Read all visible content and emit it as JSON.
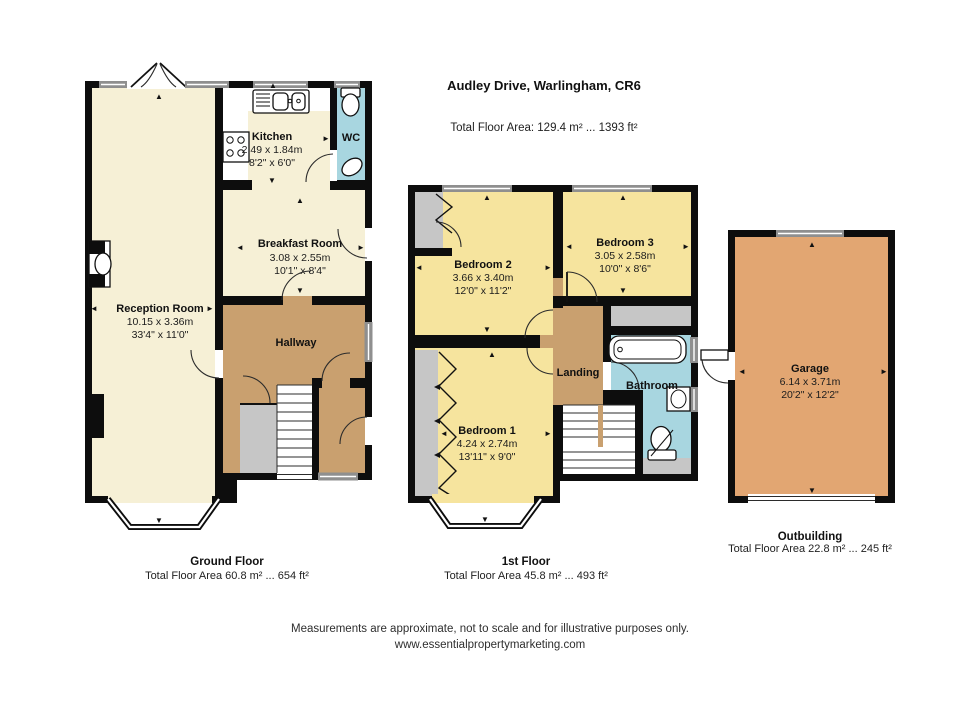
{
  "header": {
    "title": "Audley Drive, Warlingham, CR6",
    "subtitle": "Total Floor Area: 129.4 m² ... 1393 ft²"
  },
  "ground_floor": {
    "caption": "Ground Floor",
    "area": "Total Floor Area 60.8 m² ... 654 ft²",
    "rooms": {
      "reception": {
        "name": "Reception Room",
        "dim_m": "10.15 x 3.36m",
        "dim_ft": "33'4\" x 11'0\""
      },
      "kitchen": {
        "name": "Kitchen",
        "dim_m": "2.49 x 1.84m",
        "dim_ft": "8'2\" x 6'0\""
      },
      "wc": {
        "name": "WC"
      },
      "breakfast": {
        "name": "Breakfast Room",
        "dim_m": "3.08 x 2.55m",
        "dim_ft": "10'1\" x 8'4\""
      },
      "hallway": {
        "name": "Hallway"
      }
    }
  },
  "first_floor": {
    "caption": "1st Floor",
    "area": "Total Floor Area 45.8 m² ... 493 ft²",
    "rooms": {
      "bedroom1": {
        "name": "Bedroom 1",
        "dim_m": "4.24 x 2.74m",
        "dim_ft": "13'11\" x 9'0\""
      },
      "bedroom2": {
        "name": "Bedroom 2",
        "dim_m": "3.66 x 3.40m",
        "dim_ft": "12'0\" x 11'2\""
      },
      "bedroom3": {
        "name": "Bedroom 3",
        "dim_m": "3.05 x 2.58m",
        "dim_ft": "10'0\" x 8'6\""
      },
      "landing": {
        "name": "Landing"
      },
      "bathroom": {
        "name": "Bathroom"
      }
    }
  },
  "outbuilding": {
    "caption": "Outbuilding",
    "area": "Total Floor Area 22.8 m² ... 245 ft²",
    "rooms": {
      "garage": {
        "name": "Garage",
        "dim_m": "6.14 x 3.71m",
        "dim_ft": "20'2\" x 12'2\""
      }
    }
  },
  "footer": {
    "line1": "Measurements are approximate, not to scale and for illustrative purposes only.",
    "line2": "www.essentialpropertymarketing.com"
  },
  "icons": {
    "measure_up": "▲",
    "measure_down": "▼",
    "measure_left": "◄",
    "measure_right": "►"
  },
  "colors": {
    "wall": "#0d0d0d",
    "cream": "#f6f0d6",
    "bedroom_yellow": "#f6e49e",
    "hall_tan": "#c9a06f",
    "garage_orange": "#e2a672",
    "bath_blue": "#a8d6e0",
    "cupboard_gray": "#c6c6c6",
    "window_gray": "#8f8f8f"
  }
}
